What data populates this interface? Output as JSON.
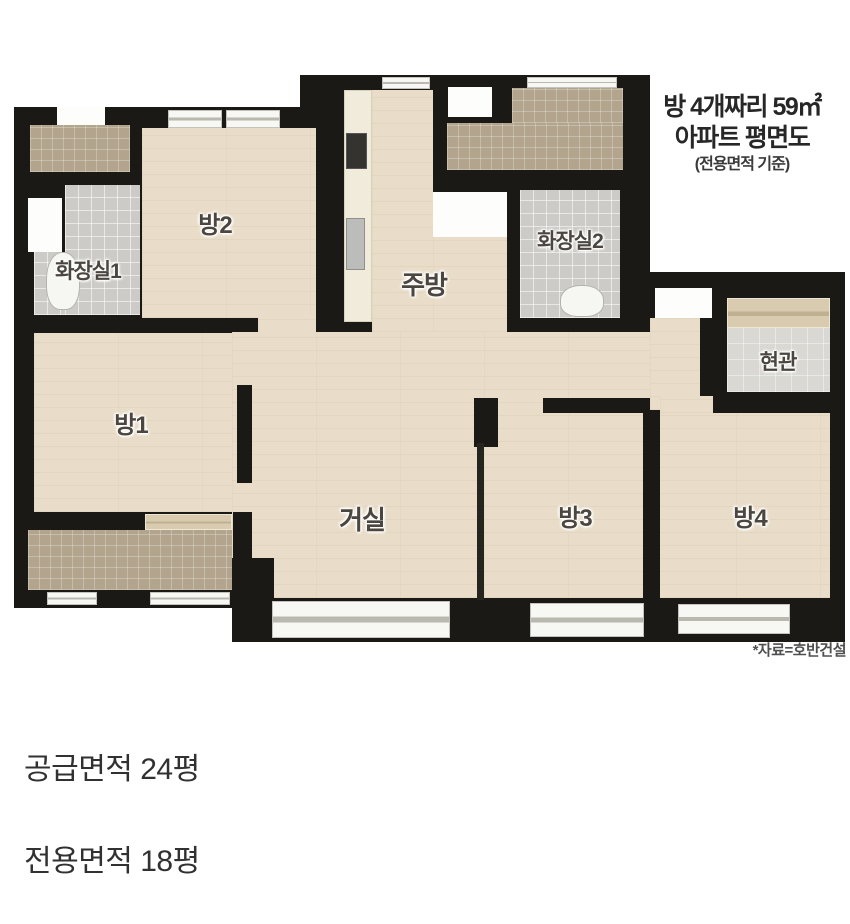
{
  "title": {
    "line1": "방 4개짜리 59㎡",
    "line2": "아파트 평면도",
    "line3": "(전용면적 기준)"
  },
  "plan": {
    "rooms": {
      "room1": "방1",
      "room2": "방2",
      "room3": "방3",
      "room4": "방4",
      "living": "거실",
      "kitchen": "주방",
      "bath1": "화장실1",
      "bath2": "화장실2",
      "entry": "현관"
    },
    "source_note": "*자료=호반건설"
  },
  "footer": {
    "supply_area": "공급면적 24평",
    "exclusive_area": "전용면적 18평"
  },
  "colors": {
    "wall": "#1b1916",
    "wood_floor": "#e9ddc9",
    "balcony_tile": "#b3a58d",
    "bathroom_tile": "#cccbc7",
    "entry_floor": "#d9d8d3",
    "counter": "#f0ebdb",
    "window_tan": "#d9cbb0"
  }
}
